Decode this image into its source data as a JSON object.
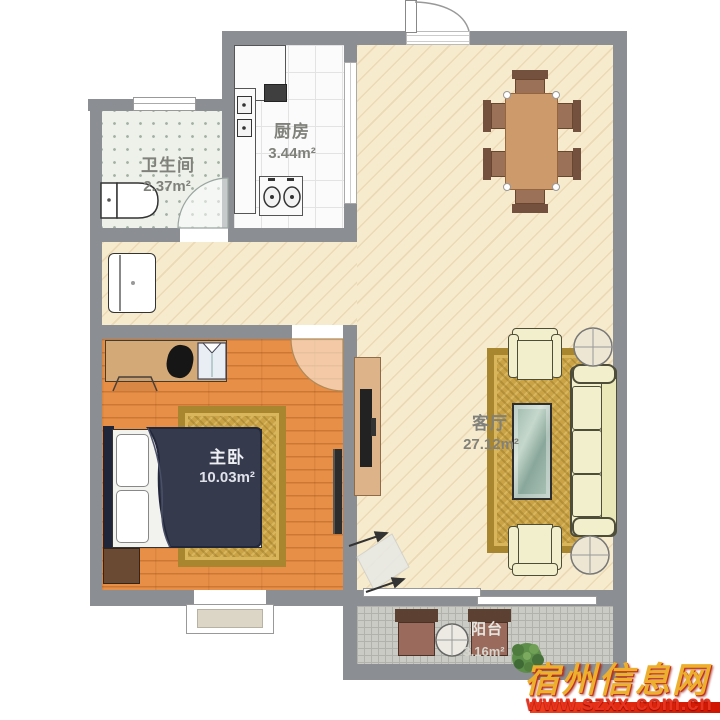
{
  "plan": {
    "rooms": {
      "bathroom": {
        "name": "卫生间",
        "area": "2.37m²"
      },
      "kitchen": {
        "name": "厨房",
        "area": "3.44m²"
      },
      "bedroom": {
        "name": "主卧",
        "area": "10.03m²"
      },
      "living_room": {
        "name": "客厅",
        "area": "27.12m²"
      },
      "balcony": {
        "name": "阳台",
        "area": "3.16m²"
      }
    }
  },
  "watermark": {
    "site_name": "宿州信息网",
    "site_url": "www.szxx.com.cn"
  },
  "colors": {
    "wall": "#8b8e92",
    "living_floor": "#f7ebcd",
    "bedroom_floor": "#e78f47",
    "bathroom_floor": "#edf1ea",
    "kitchen_floor": "#fbfbfb",
    "balcony_floor": "#cbcbc5",
    "rug_gold": "#c9a345",
    "sofa_cream": "#f2efcc",
    "duvet_navy": "#353a4d",
    "watermark_gold": "#edb02e",
    "watermark_red": "#e8331f"
  }
}
